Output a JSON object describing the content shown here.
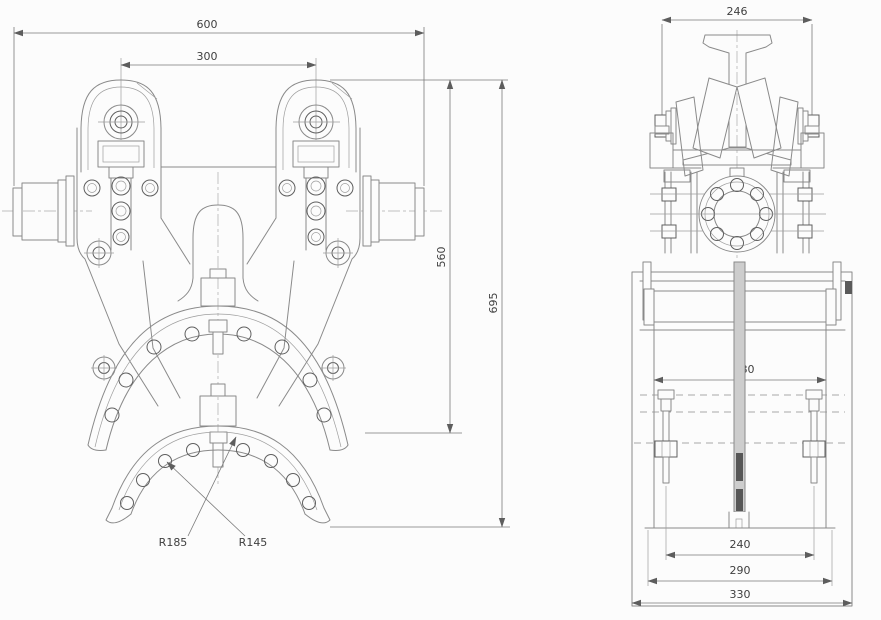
{
  "drawing": {
    "colors": {
      "background": "#fcfcfc",
      "line": "#8a8a8a",
      "dark_line": "#5f5f5f",
      "dimension_text": "#3f3f3f",
      "knurl_fill": "#ececec",
      "shaft_fill": "#cdcdcd"
    },
    "front_view": {
      "width_overall": "600",
      "wheel_spacing": "300",
      "height_to_clamp": "560",
      "height_overall": "695",
      "radius_outer": "R185",
      "radius_inner": "R145"
    },
    "side_view": {
      "width_overall": "246"
    },
    "bottom_view": {
      "inner_width": "280",
      "stud_spacing": "240",
      "frame_width": "290",
      "base_width": "330"
    }
  }
}
